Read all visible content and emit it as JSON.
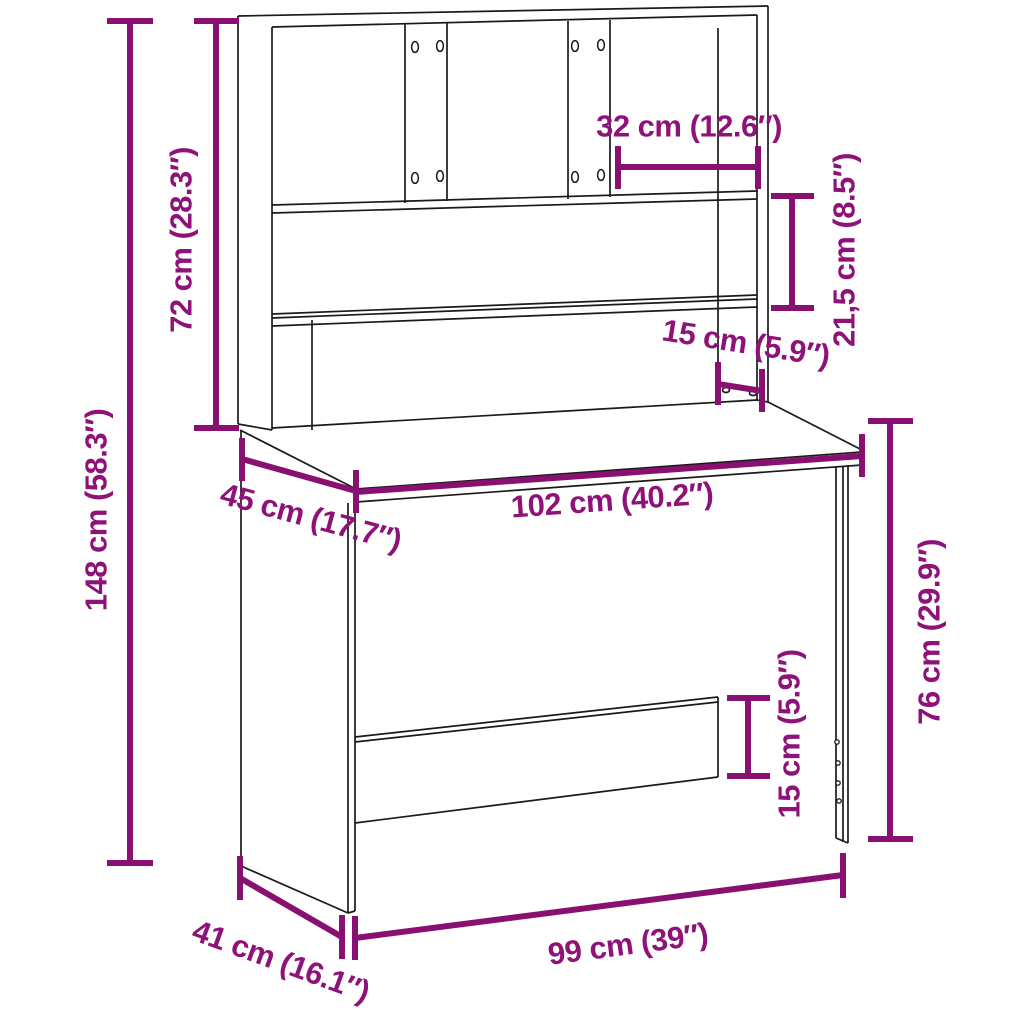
{
  "diagram": {
    "kind": "furniture-dimension-diagram",
    "subject": "desk-with-hutch"
  },
  "colors": {
    "accent_line": "#871070",
    "accent_text": "#8E1277",
    "art_line": "#1a1a1a",
    "background": "#ffffff"
  },
  "labels": {
    "total_height": "148 cm (58.3″)",
    "hutch_height": "72 cm (28.3″)",
    "compartment_width": "32 cm (12.6″)",
    "shelf_spacing": "21,5 cm (8.5″)",
    "hutch_lower_depth": "15 cm (5.9″)",
    "desktop_width": "102 cm (40.2″)",
    "desktop_depth": "45 cm (17.7″)",
    "desk_height": "76 cm (29.9″)",
    "back_panel_height": "15 cm (5.9″)",
    "base_width": "99 cm (39″)",
    "base_depth": "41 cm (16.1″)"
  }
}
